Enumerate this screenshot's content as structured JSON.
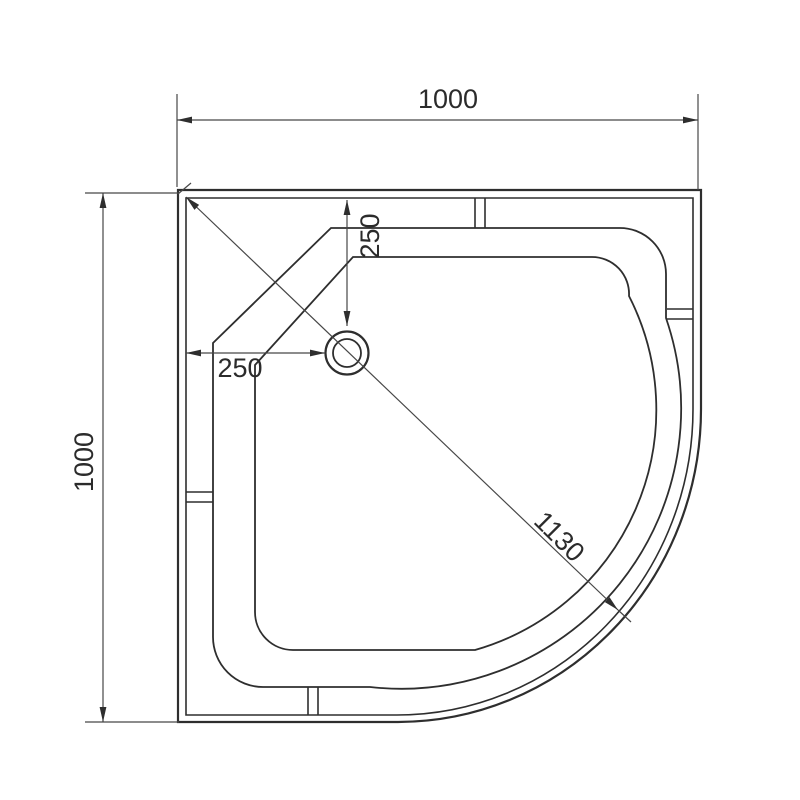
{
  "drawing": {
    "title": "corner-shower-tray-top-view",
    "colors": {
      "background": "#ffffff",
      "outline": "#2e2e2e",
      "dimension_lines": "#474747",
      "text": "#2b2b2b"
    },
    "dimensions": {
      "overall_width": "1000",
      "overall_depth": "1000",
      "drain_offset_horizontal": "250",
      "drain_offset_vertical": "250",
      "diagonal": "1130"
    }
  }
}
